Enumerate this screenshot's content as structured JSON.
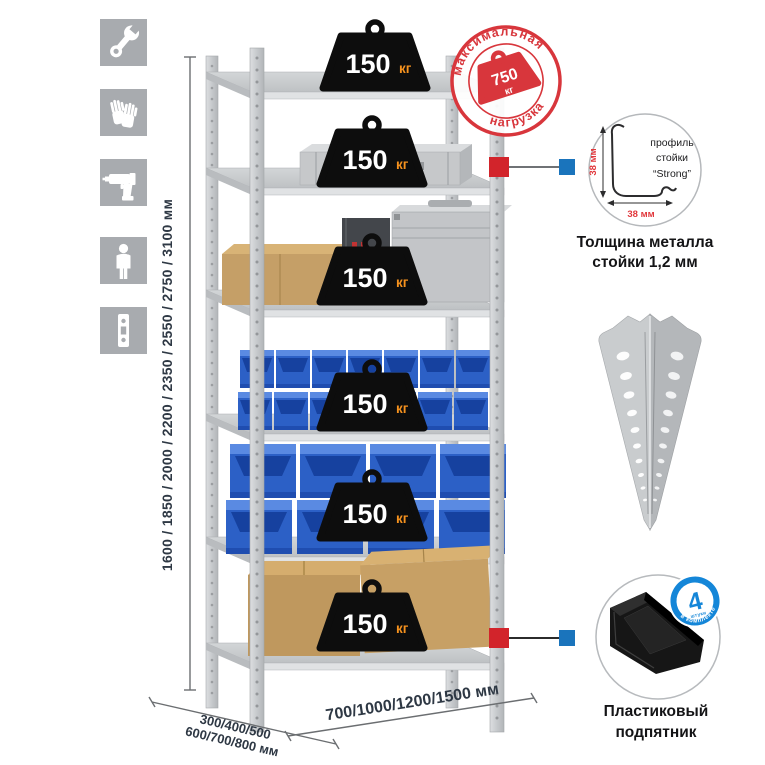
{
  "left_icons": [
    {
      "name": "wrench-icon"
    },
    {
      "name": "gloves-icon"
    },
    {
      "name": "drill-icon"
    },
    {
      "name": "person-icon"
    },
    {
      "name": "post-profile-icon"
    }
  ],
  "height_dimension": {
    "label": "1600 / 1850 / 2000 / 2200 / 2350 / 2550 / 2750 / 3100 мм"
  },
  "rack": {
    "shelf_count": 6,
    "shelf_load": {
      "value": "150",
      "unit": "кг"
    }
  },
  "max_load_stamp": {
    "arc_top": "максимальная",
    "arc_bottom": "нагрузка",
    "value": "750",
    "unit": "кг"
  },
  "profile_detail": {
    "label_line1": "профиль",
    "label_line2": "стойки",
    "label_line3": "“Strong”",
    "dim_vertical": "38 мм",
    "dim_horizontal": "38 мм",
    "caption_line1": "Толщина металла",
    "caption_line2": "стойки 1,2 мм"
  },
  "foot_detail": {
    "badge_value": "4",
    "badge_unit": "штуки",
    "badge_arc": "в комплекте",
    "caption_line1": "Пластиковый",
    "caption_line2": "подпятник"
  },
  "depth_dimension": {
    "line1": "300/400/500",
    "line2": "600/700/800 мм"
  },
  "width_dimension": {
    "label": "700/1000/1200/1500 мм"
  },
  "colors": {
    "accent_red": "#d8363c",
    "accent_blue": "#1a74bc",
    "badge_orange": "#f6921e",
    "bin_blue": "#2c60c6",
    "metal_gray": "#c9ccce",
    "icon_gray": "#a8abaf"
  }
}
